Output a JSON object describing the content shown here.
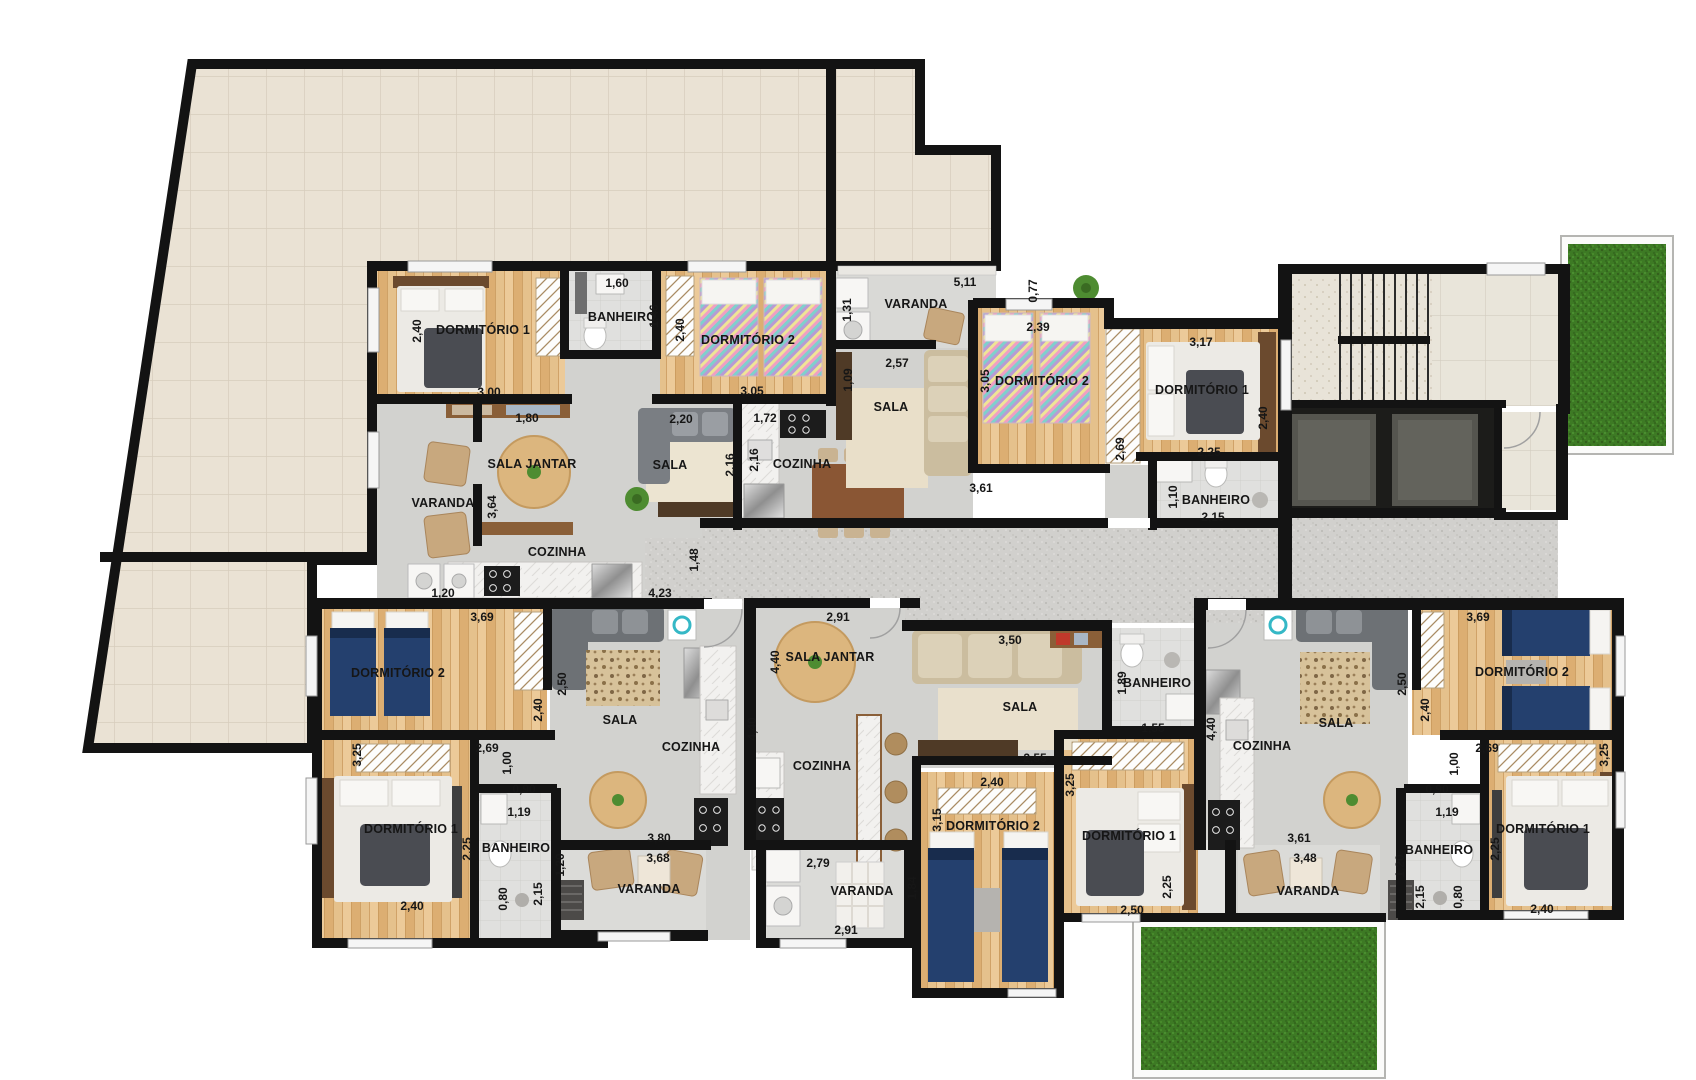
{
  "meta": {
    "type": "residential floor plan",
    "language": "pt-BR",
    "units_count": 5
  },
  "colors": {
    "wall": "#131313",
    "terrace_tile": "#eae2d4",
    "wood_floor": "#e0ba85",
    "gray_floor": "#d2d2cf",
    "corridor_floor": "#d1d0cd",
    "bathroom_tile": "#e0e0de",
    "grass": "#3d7a24",
    "bed_blue": "#24406e",
    "furniture_wood": "#8a5f38"
  },
  "units": [
    {
      "id": "apartment-top-left",
      "rooms": [
        {
          "name": "DORMITÓRIO 1",
          "x": 483,
          "y": 330
        },
        {
          "name": "BANHEIRO",
          "x": 622,
          "y": 317
        },
        {
          "name": "DORMITÓRIO 2",
          "x": 748,
          "y": 340
        },
        {
          "name": "SALA JANTAR",
          "x": 532,
          "y": 464
        },
        {
          "name": "VARANDA",
          "x": 443,
          "y": 503
        },
        {
          "name": "COZINHA",
          "x": 557,
          "y": 552
        },
        {
          "name": "SALA",
          "x": 670,
          "y": 465
        },
        {
          "name": "COZINHA",
          "x": 802,
          "y": 464
        }
      ],
      "dimensions": [
        {
          "value": "2,40",
          "x": 417,
          "y": 331,
          "vertical": true
        },
        {
          "value": "3,00",
          "x": 489,
          "y": 392
        },
        {
          "value": "1,60",
          "x": 617,
          "y": 283
        },
        {
          "value": "1,46",
          "x": 654,
          "y": 316,
          "vertical": true
        },
        {
          "value": "2,40",
          "x": 680,
          "y": 330,
          "vertical": true
        },
        {
          "value": "3,05",
          "x": 752,
          "y": 391
        },
        {
          "value": "1,80",
          "x": 527,
          "y": 418
        },
        {
          "value": "3,64",
          "x": 492,
          "y": 507,
          "vertical": true
        },
        {
          "value": "2,20",
          "x": 681,
          "y": 419
        },
        {
          "value": "2,16",
          "x": 730,
          "y": 465,
          "vertical": true
        },
        {
          "value": "1,72",
          "x": 765,
          "y": 418
        },
        {
          "value": "2,16",
          "x": 754,
          "y": 460,
          "vertical": true
        },
        {
          "value": "1,20",
          "x": 443,
          "y": 593
        },
        {
          "value": "4,23",
          "x": 660,
          "y": 593
        },
        {
          "value": "1,48",
          "x": 694,
          "y": 560,
          "vertical": true
        }
      ]
    },
    {
      "id": "apartment-top-right",
      "rooms": [
        {
          "name": "VARANDA",
          "x": 916,
          "y": 304
        },
        {
          "name": "SALA",
          "x": 891,
          "y": 407
        },
        {
          "name": "DORMITÓRIO 2",
          "x": 1042,
          "y": 381
        },
        {
          "name": "DORMITÓRIO 1",
          "x": 1202,
          "y": 390
        },
        {
          "name": "BANHEIRO",
          "x": 1216,
          "y": 500
        }
      ],
      "dimensions": [
        {
          "value": "5,11",
          "x": 965,
          "y": 282
        },
        {
          "value": "1,31",
          "x": 847,
          "y": 310,
          "vertical": true
        },
        {
          "value": "0,77",
          "x": 1033,
          "y": 291,
          "vertical": true
        },
        {
          "value": "2,57",
          "x": 897,
          "y": 363
        },
        {
          "value": "1,09",
          "x": 848,
          "y": 380,
          "vertical": true
        },
        {
          "value": "2,39",
          "x": 1038,
          "y": 327
        },
        {
          "value": "3,05",
          "x": 985,
          "y": 381,
          "vertical": true
        },
        {
          "value": "3,61",
          "x": 981,
          "y": 488
        },
        {
          "value": "2,69",
          "x": 1120,
          "y": 449,
          "vertical": true
        },
        {
          "value": "3,17",
          "x": 1201,
          "y": 342
        },
        {
          "value": "2,40",
          "x": 1263,
          "y": 418,
          "vertical": true
        },
        {
          "value": "2,25",
          "x": 1209,
          "y": 452
        },
        {
          "value": "1,10",
          "x": 1173,
          "y": 497,
          "vertical": true
        },
        {
          "value": "2,15",
          "x": 1213,
          "y": 517
        }
      ]
    },
    {
      "id": "apartment-bottom-left",
      "rooms": [
        {
          "name": "DORMITÓRIO 2",
          "x": 398,
          "y": 673
        },
        {
          "name": "SALA",
          "x": 620,
          "y": 720
        },
        {
          "name": "COZINHA",
          "x": 691,
          "y": 747
        },
        {
          "name": "DORMITÓRIO 1",
          "x": 411,
          "y": 829
        },
        {
          "name": "BANHEIRO",
          "x": 516,
          "y": 848
        },
        {
          "name": "VARANDA",
          "x": 649,
          "y": 889
        }
      ],
      "dimensions": [
        {
          "value": "3,69",
          "x": 482,
          "y": 617
        },
        {
          "value": "2,40",
          "x": 538,
          "y": 710,
          "vertical": true
        },
        {
          "value": "2,50",
          "x": 562,
          "y": 684,
          "vertical": true
        },
        {
          "value": "3,25",
          "x": 357,
          "y": 755,
          "vertical": true
        },
        {
          "value": "2,69",
          "x": 487,
          "y": 748
        },
        {
          "value": "1,00",
          "x": 507,
          "y": 763,
          "vertical": true
        },
        {
          "value": "0,90",
          "x": 524,
          "y": 789
        },
        {
          "value": "1,19",
          "x": 519,
          "y": 812
        },
        {
          "value": "2,25",
          "x": 467,
          "y": 849,
          "vertical": true
        },
        {
          "value": "2,40",
          "x": 412,
          "y": 906
        },
        {
          "value": "0,80",
          "x": 503,
          "y": 899,
          "vertical": true
        },
        {
          "value": "2,15",
          "x": 538,
          "y": 894,
          "vertical": true
        },
        {
          "value": "4,40",
          "x": 752,
          "y": 729,
          "vertical": true
        },
        {
          "value": "3,80",
          "x": 659,
          "y": 838
        },
        {
          "value": "3,68",
          "x": 658,
          "y": 858
        },
        {
          "value": "1,20",
          "x": 560,
          "y": 865,
          "vertical": true
        }
      ]
    },
    {
      "id": "apartment-bottom-middle",
      "rooms": [
        {
          "name": "SALA JANTAR",
          "x": 830,
          "y": 657
        },
        {
          "name": "COZINHA",
          "x": 822,
          "y": 766
        },
        {
          "name": "VARANDA",
          "x": 862,
          "y": 891
        },
        {
          "name": "SALA",
          "x": 1020,
          "y": 707
        },
        {
          "name": "DORMITÓRIO 2",
          "x": 993,
          "y": 826
        },
        {
          "name": "DORMITÓRIO 1",
          "x": 1129,
          "y": 836
        },
        {
          "name": "BANHEIRO",
          "x": 1157,
          "y": 683
        }
      ],
      "dimensions": [
        {
          "value": "2,91",
          "x": 838,
          "y": 617
        },
        {
          "value": "4,40",
          "x": 775,
          "y": 662,
          "vertical": true
        },
        {
          "value": "2,79",
          "x": 818,
          "y": 863
        },
        {
          "value": "2,91",
          "x": 846,
          "y": 930
        },
        {
          "value": "1,84",
          "x": 912,
          "y": 888,
          "vertical": true
        },
        {
          "value": "3,50",
          "x": 1010,
          "y": 640
        },
        {
          "value": "2,55",
          "x": 1035,
          "y": 758
        },
        {
          "value": "2,40",
          "x": 992,
          "y": 782
        },
        {
          "value": "3,15",
          "x": 937,
          "y": 820,
          "vertical": true
        },
        {
          "value": "1,89",
          "x": 1122,
          "y": 683,
          "vertical": true
        },
        {
          "value": "1,55",
          "x": 1153,
          "y": 728
        },
        {
          "value": "3,25",
          "x": 1070,
          "y": 785,
          "vertical": true
        },
        {
          "value": "2,50",
          "x": 1132,
          "y": 910
        },
        {
          "value": "2,25",
          "x": 1167,
          "y": 887,
          "vertical": true
        }
      ]
    },
    {
      "id": "apartment-bottom-right",
      "rooms": [
        {
          "name": "DORMITÓRIO 2",
          "x": 1522,
          "y": 672
        },
        {
          "name": "SALA",
          "x": 1336,
          "y": 723
        },
        {
          "name": "COZINHA",
          "x": 1262,
          "y": 746
        },
        {
          "name": "DORMITÓRIO 1",
          "x": 1543,
          "y": 829
        },
        {
          "name": "BANHEIRO",
          "x": 1439,
          "y": 850
        },
        {
          "name": "VARANDA",
          "x": 1308,
          "y": 891
        }
      ],
      "dimensions": [
        {
          "value": "3,69",
          "x": 1478,
          "y": 617
        },
        {
          "value": "2,40",
          "x": 1425,
          "y": 710,
          "vertical": true
        },
        {
          "value": "2,50",
          "x": 1402,
          "y": 684,
          "vertical": true
        },
        {
          "value": "2,69",
          "x": 1487,
          "y": 748
        },
        {
          "value": "1,00",
          "x": 1454,
          "y": 764,
          "vertical": true
        },
        {
          "value": "0,90",
          "x": 1437,
          "y": 789
        },
        {
          "value": "1,19",
          "x": 1447,
          "y": 812
        },
        {
          "value": "3,25",
          "x": 1604,
          "y": 755,
          "vertical": true
        },
        {
          "value": "2,25",
          "x": 1495,
          "y": 849,
          "vertical": true
        },
        {
          "value": "2,40",
          "x": 1542,
          "y": 909
        },
        {
          "value": "1,20",
          "x": 1400,
          "y": 866,
          "vertical": true
        },
        {
          "value": "2,15",
          "x": 1420,
          "y": 897,
          "vertical": true
        },
        {
          "value": "0,80",
          "x": 1458,
          "y": 897,
          "vertical": true
        },
        {
          "value": "4,40",
          "x": 1211,
          "y": 729,
          "vertical": true
        },
        {
          "value": "3,61",
          "x": 1299,
          "y": 838
        },
        {
          "value": "3,48",
          "x": 1305,
          "y": 858
        }
      ]
    }
  ]
}
